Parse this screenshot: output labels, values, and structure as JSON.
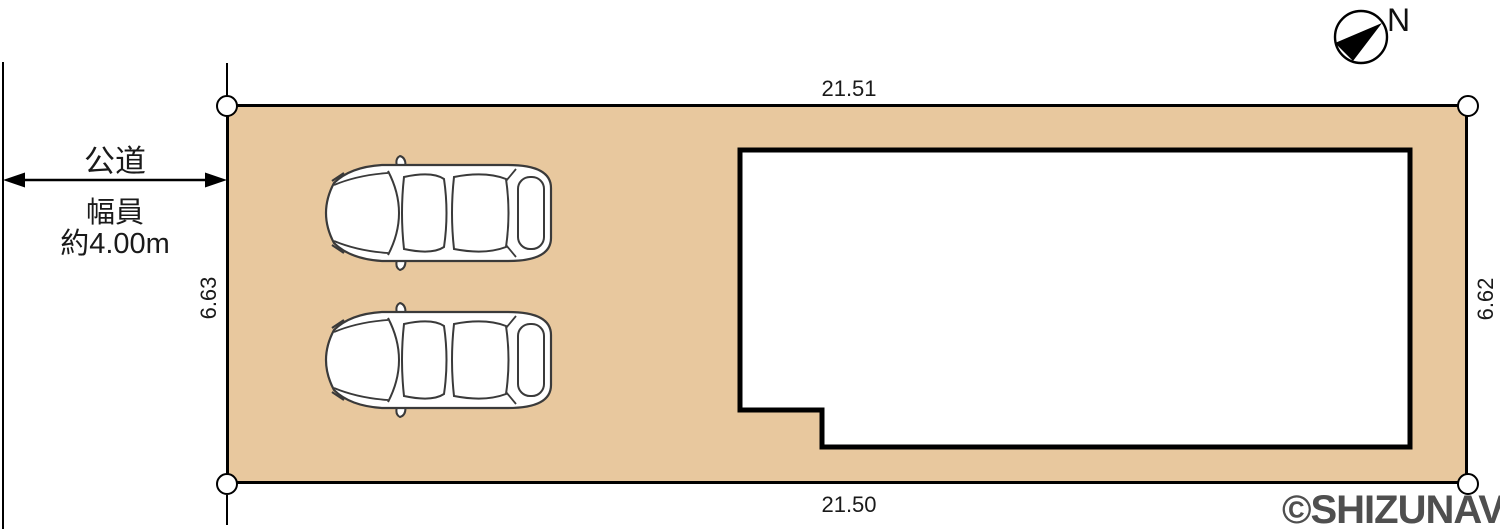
{
  "plan": {
    "compass": {
      "label": "N"
    },
    "road": {
      "name": "公道",
      "width_caption": "幅員",
      "width_value": "約4.00m"
    },
    "dimensions": {
      "top": "21.51",
      "bottom": "21.50",
      "left": "6.63",
      "right": "6.62"
    },
    "watermark": "©SHIZUNAVI",
    "colors": {
      "plot_fill": "#E8C89E",
      "line": "#000000",
      "watermark": "#4F4F4F"
    }
  }
}
